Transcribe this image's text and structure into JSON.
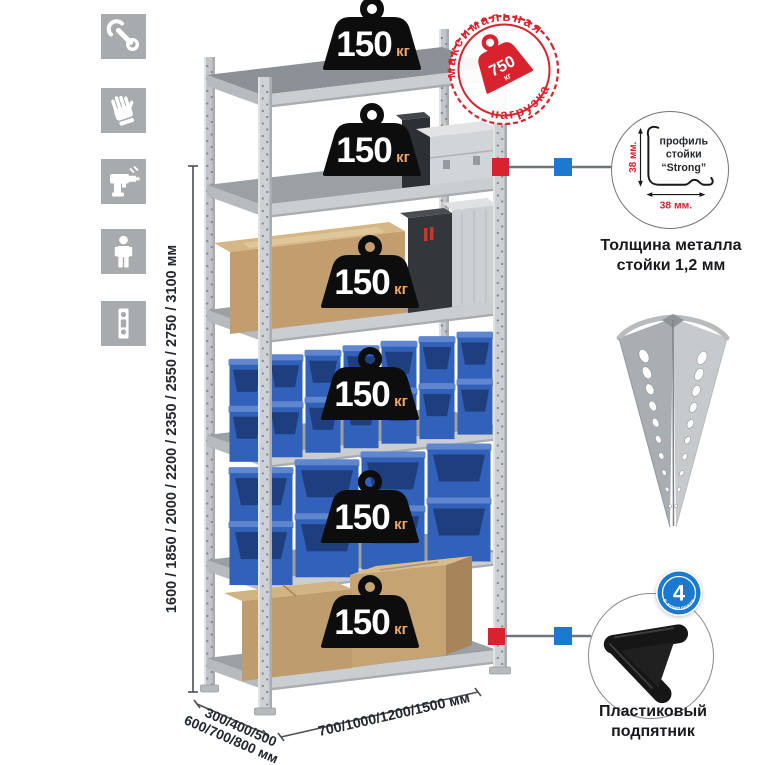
{
  "sidebar": {
    "icons": [
      {
        "name": "wrench-icon"
      },
      {
        "name": "gloves-icon"
      },
      {
        "name": "drill-icon"
      },
      {
        "name": "person-icon"
      },
      {
        "name": "post-profile-icon"
      }
    ]
  },
  "rack": {
    "shelves": [
      {
        "load": "150",
        "unit": "кг"
      },
      {
        "load": "150",
        "unit": "кг"
      },
      {
        "load": "150",
        "unit": "кг"
      },
      {
        "load": "150",
        "unit": "кг"
      },
      {
        "load": "150",
        "unit": "кг"
      },
      {
        "load": "150",
        "unit": "кг"
      }
    ],
    "stamp": {
      "arc_top": "максимальная",
      "arc_bottom": "нагрузка",
      "value": "750",
      "unit": "кг"
    }
  },
  "dimensions": {
    "height": "1600 / 1850 / 2000 / 2200 / 2350 / 2550 / 2750 / 3100 мм",
    "depth_line1": "300/400/500",
    "depth_line2": "600/700/800 мм",
    "width": "700/1000/1200/1500 мм"
  },
  "profile_detail": {
    "text_line1": "профиль",
    "text_line2": "стойки",
    "text_line3": "“Strong”",
    "dim_vertical": "38 мм.",
    "dim_horizontal": "38 мм.",
    "caption_line1": "Толщина металла",
    "caption_line2": "стойки 1,2 мм"
  },
  "foot_detail": {
    "badge_value": "4",
    "badge_text": "в комплекте",
    "caption_line1": "Пластиковый",
    "caption_line2": "подпятник"
  },
  "colors": {
    "stamp_red": "#d8232e",
    "marker_red": "#d8232e",
    "marker_blue": "#1b79cf",
    "badge_blue": "#1b79cf",
    "bin_blue": "#3161b8",
    "bin_dark": "#1e3e7e",
    "weight_black": "#0d0d0d",
    "weight_unit_orange": "#eda76b",
    "metal_gray": "#c7cacc",
    "icon_tile_gray": "#a7abad",
    "text_dark": "#23282e"
  }
}
